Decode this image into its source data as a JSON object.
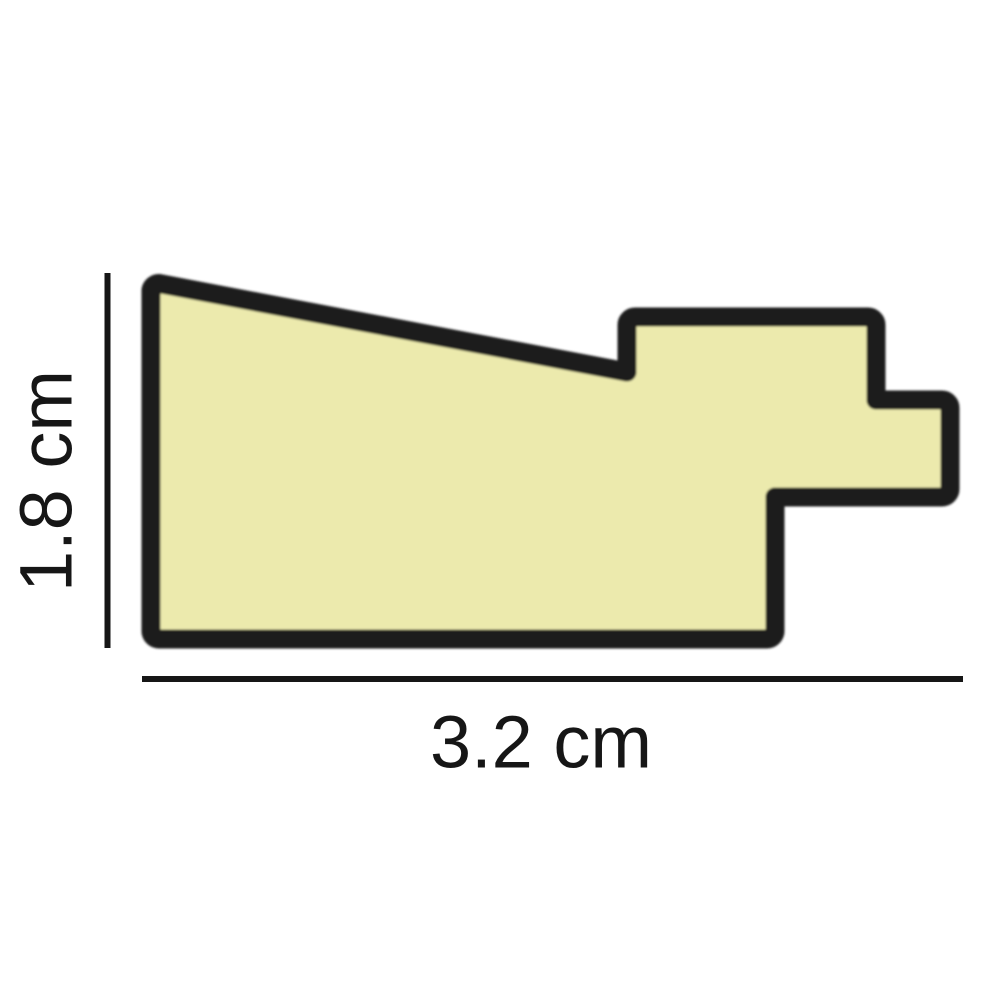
{
  "diagram": {
    "title": "moulding-profile-cross-section",
    "background_color": "#ffffff",
    "profile": {
      "fill_color": "#ECEAAD",
      "outline_color": "#1A1A1A"
    },
    "dimension_lines": {
      "color": "#161616",
      "height": {
        "label": "1.8 cm",
        "value_cm": 1.8,
        "orientation": "vertical"
      },
      "width": {
        "label": "3.2 cm",
        "value_cm": 3.2,
        "orientation": "horizontal"
      }
    }
  }
}
